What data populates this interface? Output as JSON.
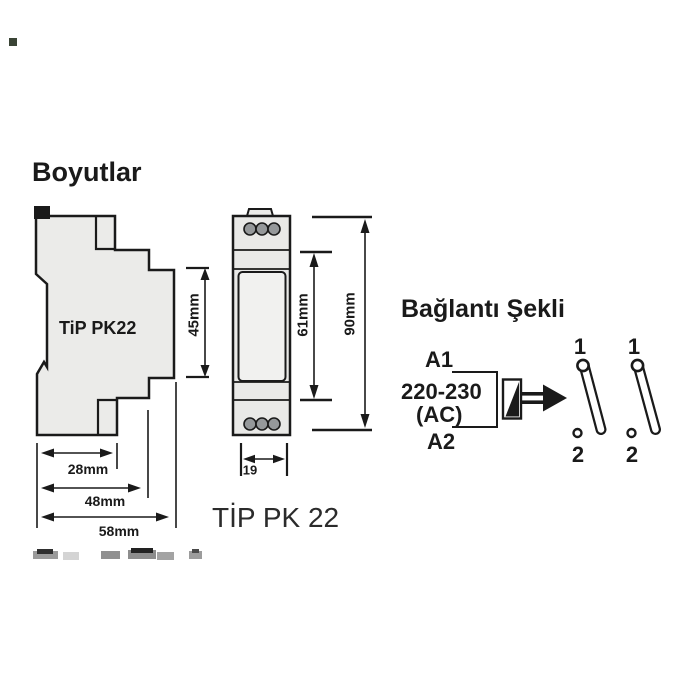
{
  "titles": {
    "dimensions": "Boyutlar",
    "connection": "Bağlantı Şekli"
  },
  "module": {
    "side_label": "TiP PK22",
    "caption": "TİP PK 22"
  },
  "dimensions": {
    "side_height": "45mm",
    "window_height": "61mm",
    "total_height": "90mm",
    "depth_inner": "28mm",
    "depth_mid": "48mm",
    "depth_total": "58mm",
    "front_width": "19"
  },
  "connection": {
    "terminal_top": "A1",
    "voltage": "220-230",
    "current_type": "(AC)",
    "terminal_bottom": "A2",
    "contacts": [
      {
        "top": "1",
        "bottom": "2"
      },
      {
        "top": "1",
        "bottom": "2"
      }
    ]
  },
  "colors": {
    "ink": "#1a1a1a",
    "body_fill": "#ebebe9",
    "window_fill": "#f1f1ef",
    "terminal_fill": "#95989a"
  }
}
